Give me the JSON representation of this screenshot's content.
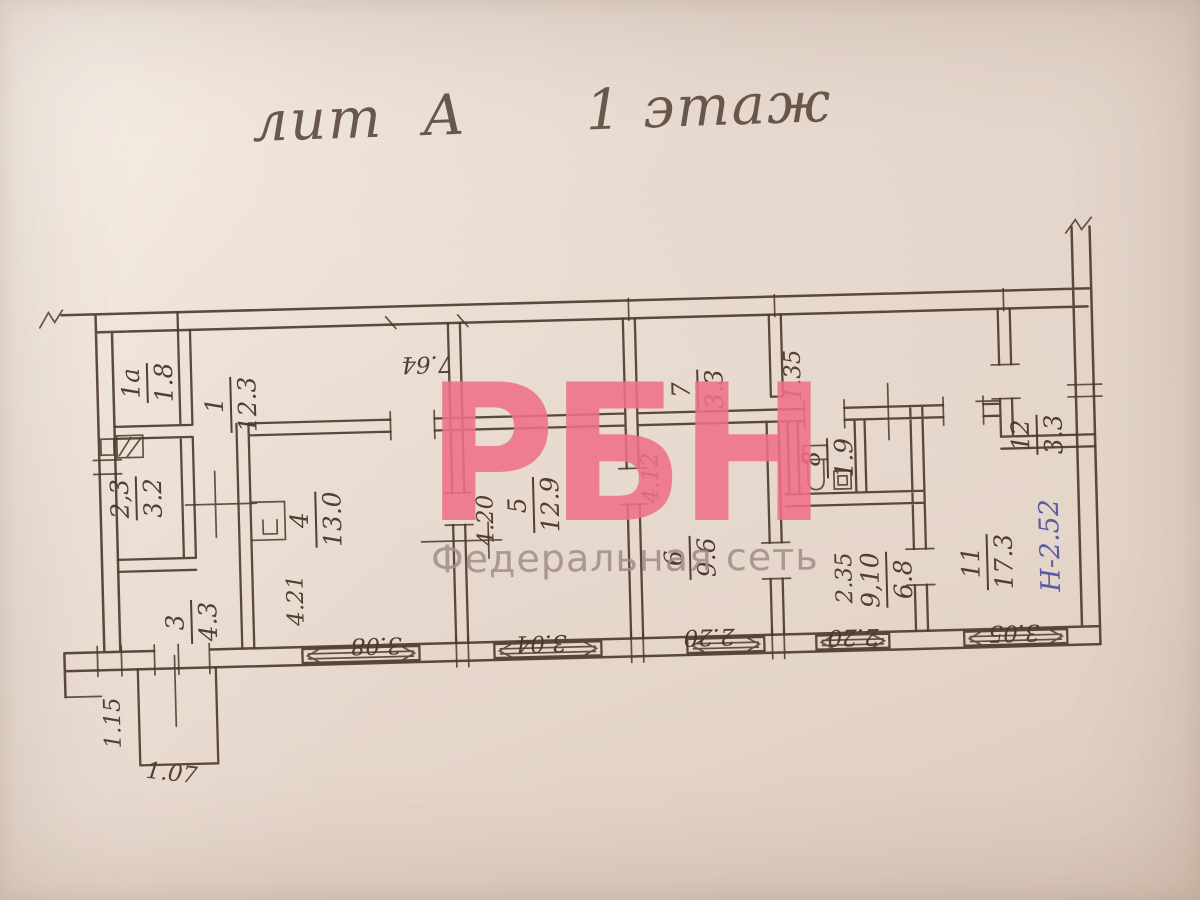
{
  "title": "лит  А      1 этаж",
  "watermark": {
    "logo": "РБН",
    "subtitle": "Федеральная сеть"
  },
  "rooms": {
    "r1a": {
      "number": "1а",
      "area": "1.8"
    },
    "r1": {
      "number": "1",
      "area": "12.3"
    },
    "r23": {
      "number": "2,3",
      "area": "3.2"
    },
    "r3": {
      "number": "3",
      "area": "4.3"
    },
    "r4": {
      "number": "4",
      "area": "13.0"
    },
    "r5": {
      "number": "5",
      "area": "12.9"
    },
    "r6": {
      "number": "6",
      "area": "9.6"
    },
    "r7": {
      "number": "7",
      "area": "3.3"
    },
    "r8": {
      "number": "8",
      "area": "1.9"
    },
    "r910": {
      "number": "9,10",
      "area": "6.8"
    },
    "r11": {
      "number": "11",
      "area": "17.3"
    },
    "r12": {
      "number": "12",
      "area": "3.3"
    }
  },
  "dimensions": {
    "corridor_length": "7.64",
    "room4_depth": "4.21",
    "room5_depth": "4.20",
    "room6_depth": "4.12",
    "passage_width": "1.35",
    "room910_width": "2.35",
    "window_room4": "3.08",
    "window_room5": "3.04",
    "window_room6": "2.20",
    "window_room910": "2.20",
    "window_room11": "3.05",
    "porch_depth": "1.15",
    "porch_width": "1.07",
    "height_mark": "Н-2.52"
  },
  "colors": {
    "ink": "#4b3828",
    "blue_ink": "#4c52a2",
    "watermark_pink": "#ee7187",
    "watermark_gray": "#9f8e89",
    "paper": "#e8dacf"
  }
}
